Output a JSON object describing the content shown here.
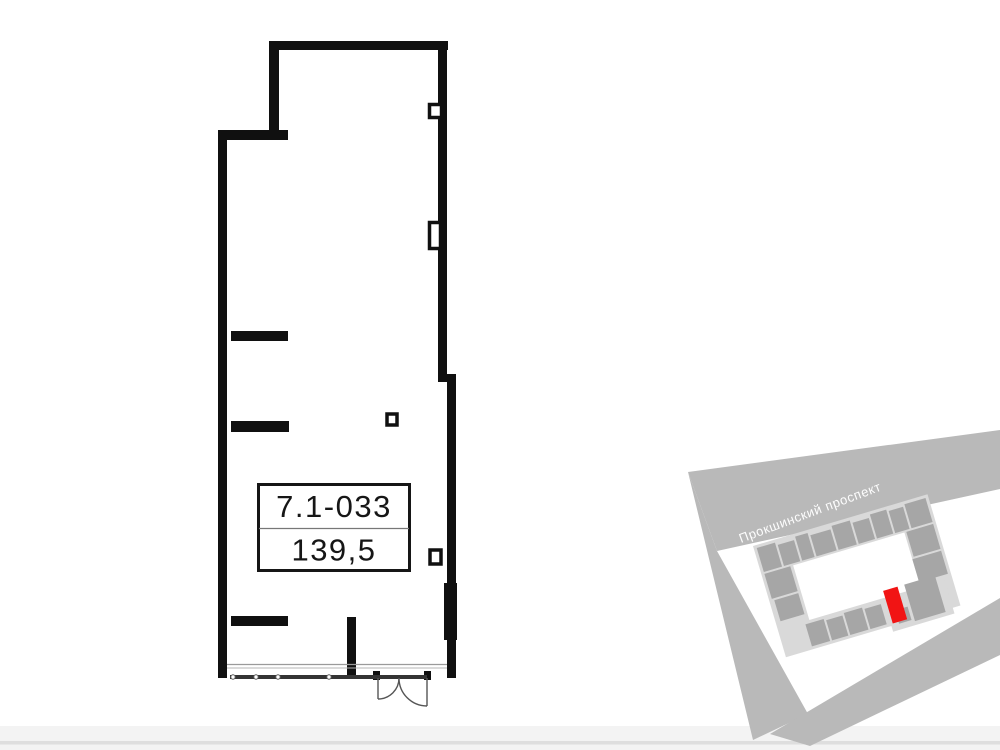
{
  "floor_plan": {
    "unit_number": "7.1-033",
    "area": "139,5",
    "wall_color": "#101010",
    "storefront_line_color": "#343434",
    "door_line_color": "#555555"
  },
  "site_plan": {
    "street_label": "Прокшинский проспект",
    "street_label_color": "#fdfdfd",
    "road_color": "#b9b9b9",
    "building_base_color": "#d9d9d9",
    "building_unit_color": "#a6a6a6",
    "highlighted_unit_color": "#f11414"
  }
}
